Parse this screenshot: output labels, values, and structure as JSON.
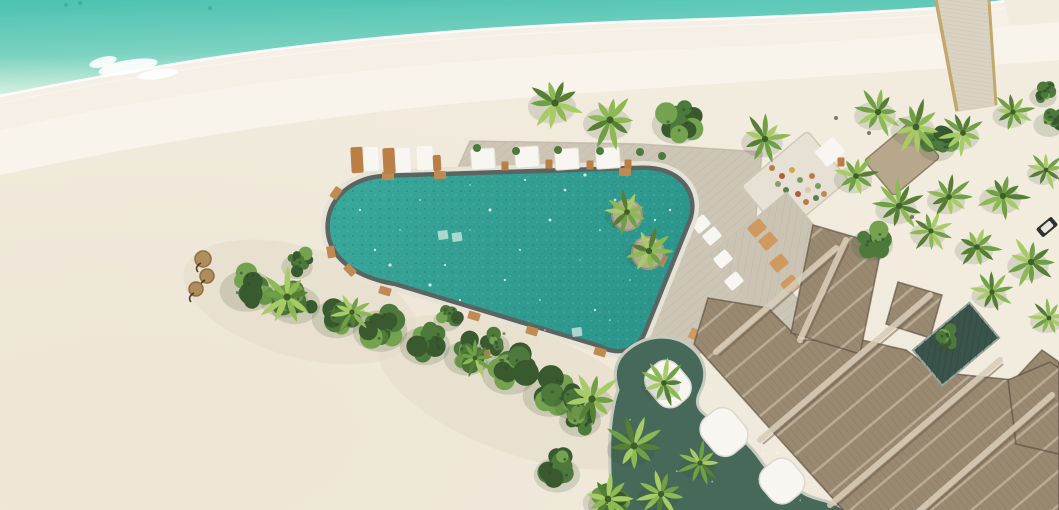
{
  "meta": {
    "description": "Aerial drone photograph of a tropical island beach resort with freeform pool, sun deck, jetty and thatched-roof buildings",
    "width": 1059,
    "height": 510
  },
  "palette": {
    "ocean_deep": "#4cc2b0",
    "ocean_mid": "#7bd2c0",
    "ocean_shallow": "#c4ead9",
    "foam": "#ffffff",
    "sand": "#f2ecdf",
    "sand_bright": "#f9f5ec",
    "sand_wet": "#f5efe5",
    "sand_warm": "#e9e1cf",
    "pool_water_a": "#3aa89b",
    "pool_water_b": "#2c968c",
    "pool_speckle": "#1e8076",
    "pool_rim": "#5a6562",
    "pool_halo": "#e7e2d6",
    "deck": "#cdc6b7",
    "deck_line": "#b5ac9a",
    "platform": "#e6e1d4",
    "sunbed_deck": "#cbc4b4",
    "wood": "#b97f45",
    "wood_light": "#cf9a60",
    "white_furniture": "#f7f6f1",
    "thatch": "#9a8971",
    "thatch_light": "#d8cdb8",
    "thatch_dark": "#6b5d4c",
    "thatch_edge": "#55483b",
    "terrace_green": "#47695a",
    "terrace_curb": "#c6cabf",
    "courtyard": "#3b544b",
    "foliage_dark": "#39592f",
    "foliage_mid": "#4d7a3c",
    "foliage_light": "#74a24e",
    "palm_a": "#567f35",
    "palm_b": "#6fa044",
    "palm_c": "#8cb952",
    "palm_d": "#a7cc66",
    "jetty": "#dad2c2",
    "jetty_rail": "#c3a86d",
    "parasol": "#b08d5c",
    "speck": "#5c5c50"
  },
  "paths": {
    "shoreline": "M0,96 C120,72 220,55 320,44 C420,33 520,26 620,22 C710,19 780,17 850,13 C910,10 960,7 1004,1",
    "ocean": "M0,0 H1004 C960,7 910,10 850,13 C780,17 710,19 620,22 C520,26 420,33 320,44 C220,55 120,72 0,96 Z",
    "wet_band": "M0,96 C120,72 220,55 320,44 C420,33 520,26 620,22 C710,19 780,17 850,13 C910,10 960,7 1004,1 L1010,26 C950,32 900,36 850,40 C760,46 700,48 615,52 C515,57 420,64 325,75 C225,86 120,104 0,130 Z",
    "bright_band": "M0,130 C120,104 225,86 325,75 C420,64 515,57 615,52 C700,48 760,46 850,40 C900,36 950,32 1010,26 L1059,22 V60 C900,72 700,84 520,98 C350,111 160,140 0,175 Z",
    "deck": "M447,192 L470,141 L640,144 L762,152 L753,246 L800,302 L797,346 L700,353 L612,342 L500,308 Z",
    "pool": "M386,178 L642,170 C676,169 697,191 688,219 L643,331 C636,350 616,353 601,344 L396,282 C345,273 328,248 330,223 C332,197 356,179 386,178 Z",
    "terrace": "M612,512 C609,462 607,420 618,390 C612,372 616,358 630,348 C650,333 676,334 692,348 C706,360 708,377 700,392 C694,404 698,412 714,420 C734,430 750,444 762,462 C770,474 786,480 802,492 C814,501 836,500 848,512 Z",
    "roof_main": "M845,512 L694,344 L708,298 L768,308 L800,340 L862,340 L906,350 L936,372 L1014,380 L1042,350 L1059,362 L1059,512 Z",
    "roof_wing": "M791,333 L813,225 L882,245 L860,354 Z",
    "roof_wing2": "M886,324 L898,282 L942,295 L930,338 Z",
    "roof_right": "M1008,380 L1050,362 L1059,368 L1059,454 L1016,444 Z"
  },
  "jetty": {
    "quad": "M935,0 L990,0 L997,106 L956,112 Z"
  },
  "foam_patches": [
    {
      "x": 128,
      "y": 67,
      "rx": 30,
      "ry": 7,
      "rot": -10
    },
    {
      "x": 158,
      "y": 74,
      "rx": 20,
      "ry": 5,
      "rot": -8
    },
    {
      "x": 103,
      "y": 62,
      "rx": 14,
      "ry": 5,
      "rot": -14
    }
  ],
  "ridge_highlights": [
    {
      "x1": 716,
      "y1": 352,
      "x2": 836,
      "y2": 248
    },
    {
      "x1": 760,
      "y1": 440,
      "x2": 930,
      "y2": 295
    },
    {
      "x1": 830,
      "y1": 505,
      "x2": 1000,
      "y2": 360
    },
    {
      "x1": 918,
      "y1": 512,
      "x2": 1052,
      "y2": 395
    },
    {
      "x1": 800,
      "y1": 340,
      "x2": 846,
      "y2": 240
    },
    {
      "x1": 888,
      "y1": 172,
      "x2": 918,
      "y2": 146
    }
  ],
  "hut": {
    "x": 902,
    "y": 159,
    "w": 60,
    "h": 46,
    "rot": -40
  },
  "courtyard": {
    "x": 956,
    "y": 344,
    "w": 74,
    "h": 46,
    "rot": -40
  },
  "planters": [
    {
      "x": 627,
      "y": 215,
      "r": 15
    },
    {
      "x": 648,
      "y": 253,
      "r": 16
    }
  ],
  "planter_palms": [
    {
      "x": 627,
      "y": 212,
      "r": 24
    },
    {
      "x": 649,
      "y": 251,
      "r": 26
    }
  ],
  "loungers_sand": [
    {
      "x": 357,
      "y": 160,
      "w": 12,
      "h": 26,
      "c": "wood"
    },
    {
      "x": 371,
      "y": 159,
      "w": 15,
      "h": 24,
      "c": "white"
    },
    {
      "x": 389,
      "y": 161,
      "w": 12,
      "h": 26,
      "c": "wood"
    },
    {
      "x": 403,
      "y": 160,
      "w": 15,
      "h": 24,
      "c": "white"
    },
    {
      "x": 425,
      "y": 158,
      "w": 16,
      "h": 24,
      "c": "white"
    },
    {
      "x": 437,
      "y": 163,
      "w": 8,
      "h": 16,
      "c": "wood"
    }
  ],
  "loungers_deck": [
    {
      "x": 483,
      "y": 159,
      "w": 24,
      "h": 21
    },
    {
      "x": 527,
      "y": 157,
      "w": 24,
      "h": 21
    },
    {
      "x": 567,
      "y": 159,
      "w": 24,
      "h": 21
    },
    {
      "x": 608,
      "y": 158,
      "w": 24,
      "h": 21
    }
  ],
  "lounger_extra": {
    "x": 830,
    "y": 152,
    "w": 24,
    "h": 20,
    "rot": -40
  },
  "side_tables": [
    {
      "x": 505,
      "y": 166
    },
    {
      "x": 549,
      "y": 164
    },
    {
      "x": 590,
      "y": 165
    },
    {
      "x": 628,
      "y": 164
    },
    {
      "x": 841,
      "y": 162
    }
  ],
  "deck_plants": [
    {
      "x": 477,
      "y": 148
    },
    {
      "x": 516,
      "y": 151
    },
    {
      "x": 558,
      "y": 150
    },
    {
      "x": 600,
      "y": 151
    },
    {
      "x": 640,
      "y": 152
    },
    {
      "x": 662,
      "y": 156
    }
  ],
  "sunbeds_grid": [
    {
      "x": 701,
      "y": 224,
      "c": "white"
    },
    {
      "x": 712,
      "y": 236,
      "c": "white"
    },
    {
      "x": 723,
      "y": 259,
      "c": "white"
    },
    {
      "x": 734,
      "y": 281,
      "c": "white"
    },
    {
      "x": 757,
      "y": 228,
      "c": "wood"
    },
    {
      "x": 768,
      "y": 241,
      "c": "wood"
    },
    {
      "x": 779,
      "y": 263,
      "c": "wood"
    },
    {
      "x": 790,
      "y": 284,
      "c": "wood"
    }
  ],
  "benches": [
    {
      "x": 470,
      "y": 341
    },
    {
      "x": 489,
      "y": 351
    },
    {
      "x": 508,
      "y": 361
    },
    {
      "x": 527,
      "y": 371
    }
  ],
  "dining_chairs": [
    {
      "x": 694,
      "y": 334
    },
    {
      "x": 706,
      "y": 341
    }
  ],
  "platform": {
    "x": 795,
    "y": 183,
    "w": 86,
    "h": 64,
    "rot": -40
  },
  "platform_dots": [
    {
      "x": 772,
      "y": 168,
      "c": "#c07a4a"
    },
    {
      "x": 782,
      "y": 176,
      "c": "#b5593f"
    },
    {
      "x": 792,
      "y": 170,
      "c": "#c9a84f"
    },
    {
      "x": 800,
      "y": 180,
      "c": "#7d9a62"
    },
    {
      "x": 812,
      "y": 176,
      "c": "#c07a4a"
    },
    {
      "x": 786,
      "y": 190,
      "c": "#5d7e4f"
    },
    {
      "x": 798,
      "y": 194,
      "c": "#b5593f"
    },
    {
      "x": 808,
      "y": 190,
      "c": "#d9c9a8"
    },
    {
      "x": 818,
      "y": 186,
      "c": "#7d9a62"
    },
    {
      "x": 778,
      "y": 184,
      "c": "#8a9a72"
    },
    {
      "x": 806,
      "y": 202,
      "c": "#c07a4a"
    },
    {
      "x": 816,
      "y": 198,
      "c": "#5d7e4f"
    },
    {
      "x": 824,
      "y": 194,
      "c": "#b98a54"
    },
    {
      "x": 790,
      "y": 204,
      "c": "#c9a84f"
    }
  ],
  "canopies": [
    {
      "x": 668,
      "y": 384,
      "w": 38,
      "h": 46
    },
    {
      "x": 724,
      "y": 432,
      "w": 40,
      "h": 46
    },
    {
      "x": 782,
      "y": 481,
      "w": 40,
      "h": 42
    }
  ],
  "parasols": [
    {
      "x": 203,
      "y": 259,
      "r": 8
    },
    {
      "x": 207,
      "y": 276,
      "r": 7
    },
    {
      "x": 196,
      "y": 289,
      "r": 7
    }
  ],
  "rim_tabs": [
    {
      "x": 388,
      "y": 176,
      "r": 0
    },
    {
      "x": 440,
      "y": 175,
      "r": 0
    },
    {
      "x": 625,
      "y": 172,
      "r": 0
    },
    {
      "x": 336,
      "y": 193,
      "r": -55
    },
    {
      "x": 331,
      "y": 252,
      "r": 80
    },
    {
      "x": 350,
      "y": 270,
      "r": 45
    },
    {
      "x": 385,
      "y": 291,
      "r": 17
    },
    {
      "x": 474,
      "y": 316,
      "r": 17
    },
    {
      "x": 532,
      "y": 331,
      "r": 17
    },
    {
      "x": 662,
      "y": 260,
      "r": -65
    },
    {
      "x": 600,
      "y": 352,
      "r": 17
    }
  ],
  "pool_steps": [
    {
      "x": 443,
      "y": 235
    },
    {
      "x": 457,
      "y": 237
    },
    {
      "x": 577,
      "y": 332
    }
  ],
  "sparkles": [
    360,
    210,
    375,
    250,
    400,
    230,
    420,
    200,
    445,
    265,
    460,
    300,
    470,
    230,
    490,
    210,
    505,
    280,
    520,
    250,
    540,
    300,
    550,
    220,
    565,
    190,
    580,
    260,
    595,
    310,
    600,
    230,
    615,
    200,
    630,
    280,
    640,
    240,
    655,
    220,
    545,
    330,
    500,
    320,
    430,
    285,
    390,
    265,
    470,
    185,
    525,
    180,
    585,
    175,
    610,
    320,
    660,
    250,
    670,
    210
  ],
  "bushy_trees": [
    {
      "x": 250,
      "y": 286,
      "r": 26
    },
    {
      "x": 298,
      "y": 300,
      "r": 24
    },
    {
      "x": 340,
      "y": 314,
      "r": 24
    },
    {
      "x": 383,
      "y": 326,
      "r": 26
    },
    {
      "x": 300,
      "y": 262,
      "r": 15
    },
    {
      "x": 428,
      "y": 341,
      "r": 24
    },
    {
      "x": 470,
      "y": 353,
      "r": 22
    },
    {
      "x": 512,
      "y": 369,
      "r": 26
    },
    {
      "x": 553,
      "y": 391,
      "r": 26
    },
    {
      "x": 583,
      "y": 416,
      "r": 20
    },
    {
      "x": 450,
      "y": 316,
      "r": 13
    },
    {
      "x": 497,
      "y": 341,
      "r": 15
    },
    {
      "x": 680,
      "y": 120,
      "r": 24
    },
    {
      "x": 875,
      "y": 240,
      "r": 20
    },
    {
      "x": 940,
      "y": 142,
      "r": 18
    },
    {
      "x": 575,
      "y": 401,
      "r": 17
    },
    {
      "x": 560,
      "y": 470,
      "r": 22
    },
    {
      "x": 612,
      "y": 500,
      "r": 20
    },
    {
      "x": 1052,
      "y": 120,
      "r": 15
    },
    {
      "x": 1046,
      "y": 92,
      "r": 13
    }
  ],
  "palms": [
    {
      "x": 555,
      "y": 103,
      "r": 30
    },
    {
      "x": 610,
      "y": 120,
      "r": 30
    },
    {
      "x": 765,
      "y": 139,
      "r": 26
    },
    {
      "x": 287,
      "y": 297,
      "r": 30
    },
    {
      "x": 352,
      "y": 312,
      "r": 22
    },
    {
      "x": 475,
      "y": 358,
      "r": 20
    },
    {
      "x": 878,
      "y": 112,
      "r": 26
    },
    {
      "x": 916,
      "y": 127,
      "r": 28
    },
    {
      "x": 963,
      "y": 133,
      "r": 24
    },
    {
      "x": 1013,
      "y": 112,
      "r": 22
    },
    {
      "x": 856,
      "y": 176,
      "r": 24
    },
    {
      "x": 899,
      "y": 206,
      "r": 26
    },
    {
      "x": 949,
      "y": 197,
      "r": 24
    },
    {
      "x": 1003,
      "y": 196,
      "r": 26
    },
    {
      "x": 931,
      "y": 231,
      "r": 22
    },
    {
      "x": 977,
      "y": 247,
      "r": 24
    },
    {
      "x": 1031,
      "y": 262,
      "r": 26
    },
    {
      "x": 1046,
      "y": 170,
      "r": 20
    },
    {
      "x": 992,
      "y": 292,
      "r": 22
    },
    {
      "x": 1049,
      "y": 318,
      "r": 20
    },
    {
      "x": 592,
      "y": 399,
      "r": 30
    },
    {
      "x": 634,
      "y": 446,
      "r": 30
    },
    {
      "x": 664,
      "y": 383,
      "r": 24
    },
    {
      "x": 608,
      "y": 499,
      "r": 28
    },
    {
      "x": 661,
      "y": 494,
      "r": 26
    },
    {
      "x": 700,
      "y": 463,
      "r": 22
    }
  ],
  "courtyard_bush": {
    "x": 947,
    "y": 337,
    "r": 13
  },
  "buggy": {
    "x": 1047,
    "y": 227,
    "rot": -40
  },
  "ocean_specks": [
    {
      "x": 66,
      "y": 5
    },
    {
      "x": 80,
      "y": 3
    },
    {
      "x": 210,
      "y": 8
    }
  ],
  "sand_specks": [
    {
      "x": 912,
      "y": 217
    },
    {
      "x": 869,
      "y": 133
    },
    {
      "x": 836,
      "y": 118
    }
  ],
  "tree_shadows": [
    {
      "x": 300,
      "y": 302,
      "rx": 120,
      "ry": 55,
      "rot": 16
    },
    {
      "x": 520,
      "y": 392,
      "rx": 150,
      "ry": 62,
      "rot": 20
    }
  ]
}
